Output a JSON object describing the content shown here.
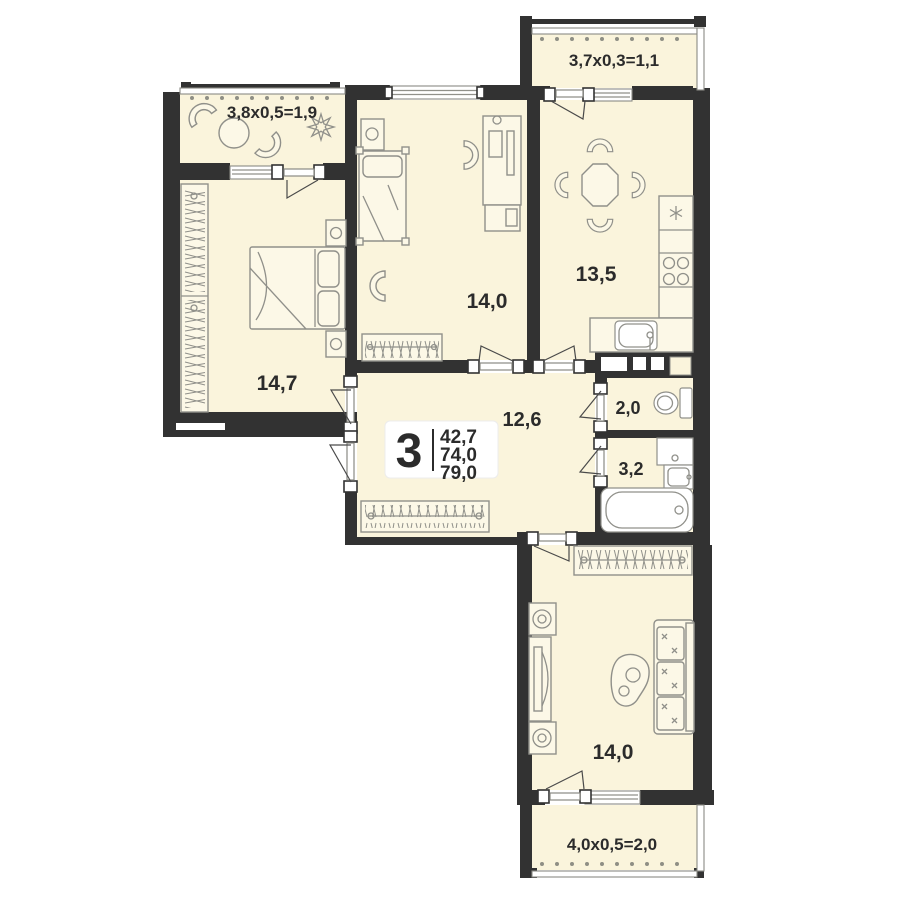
{
  "floorplan": {
    "unit": {
      "rooms_count": "3",
      "area_living": "42,7",
      "area_heated": "74,0",
      "area_total": "79,0"
    },
    "rooms": {
      "balcony_tl": {
        "label": "3,8x0,5=1,9"
      },
      "bedroom_left": {
        "label": "14,7"
      },
      "bedroom_mid": {
        "label": "14,0"
      },
      "balcony_tr": {
        "label": "3,7x0,3=1,1"
      },
      "kitchen": {
        "label": "13,5"
      },
      "hallway": {
        "label": "12,6"
      },
      "toilet": {
        "label": "2,0"
      },
      "bathroom": {
        "label": "3,2"
      },
      "living": {
        "label": "14,0"
      },
      "balcony_bottom": {
        "label": "4,0x0,5=2,0"
      }
    },
    "colors": {
      "wall": "#323232",
      "floor": "#FAF4DC",
      "furniture_line": "#90908A",
      "text": "#2B2B2B",
      "background": "#FFFFFF"
    }
  }
}
